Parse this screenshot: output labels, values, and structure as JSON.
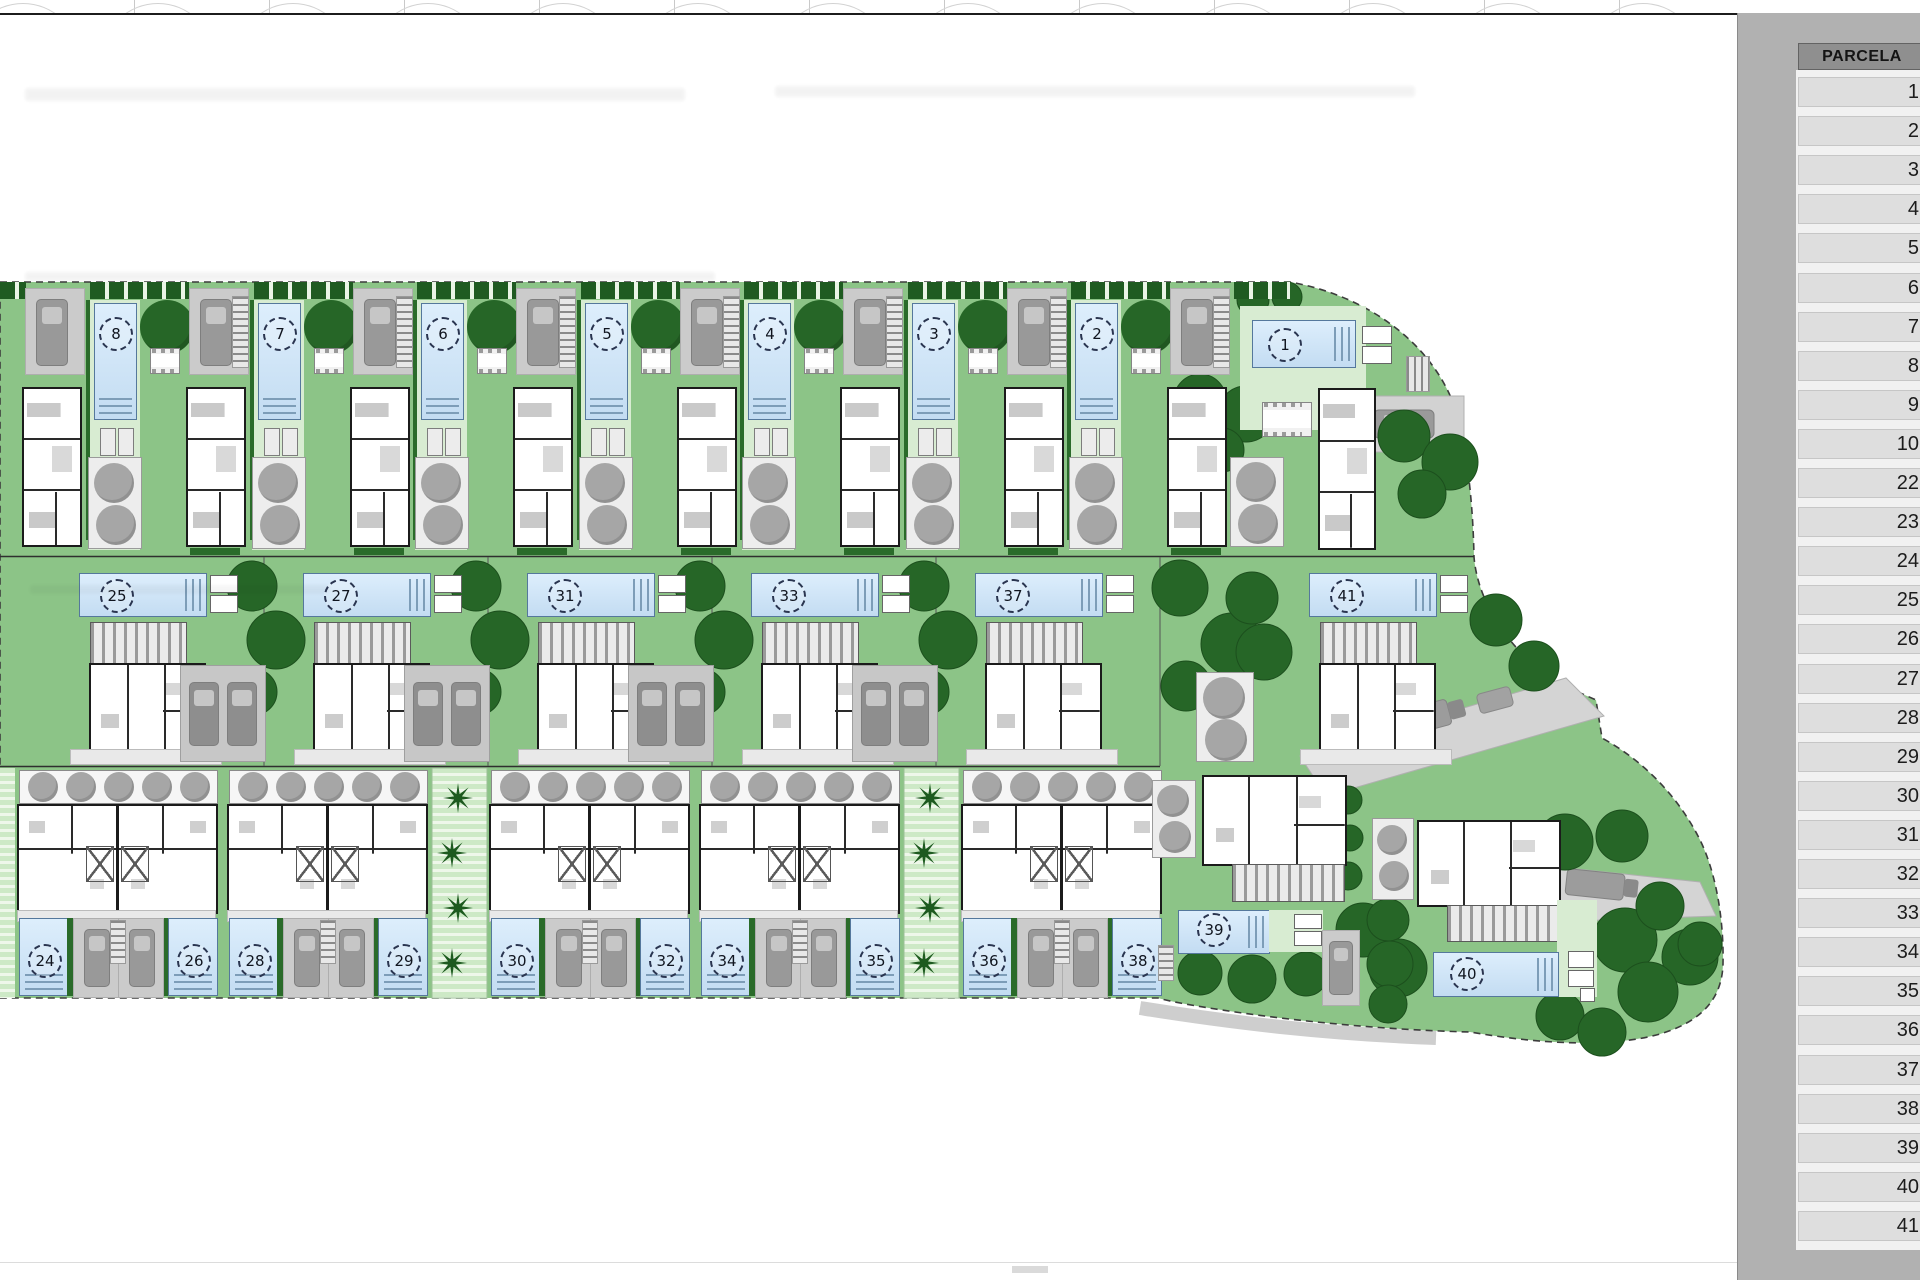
{
  "sidebar": {
    "header": "PARCELA",
    "rows": [
      "1",
      "2",
      "3",
      "4",
      "5",
      "6",
      "7",
      "8",
      "9",
      "10",
      "22",
      "23",
      "24",
      "25",
      "26",
      "27",
      "28",
      "29",
      "30",
      "31",
      "32",
      "33",
      "34",
      "35",
      "36",
      "37",
      "38",
      "39",
      "40",
      "41"
    ]
  },
  "plan": {
    "top_villas": [
      "8",
      "7",
      "6",
      "5",
      "4",
      "3",
      "2"
    ],
    "corner_top": "1",
    "middle_villas": [
      "25",
      "27",
      "31",
      "33",
      "37"
    ],
    "corner_middle": "41",
    "duplex_groups": [
      [
        "24",
        "26"
      ],
      [
        "28",
        "29"
      ],
      [
        "30",
        "32"
      ],
      [
        "34",
        "35"
      ],
      [
        "36",
        "38"
      ]
    ],
    "detached": [
      "39",
      "40"
    ]
  },
  "colors": {
    "site_green": "#8cc487",
    "tree_green": "#266627",
    "pool_blue": "#cfe3f4",
    "driveway_gray": "#cbcbcb",
    "sidebar_gray": "#b1b1b1",
    "table_row_gray": "#dedede",
    "table_header_gray": "#8f8f8f"
  }
}
